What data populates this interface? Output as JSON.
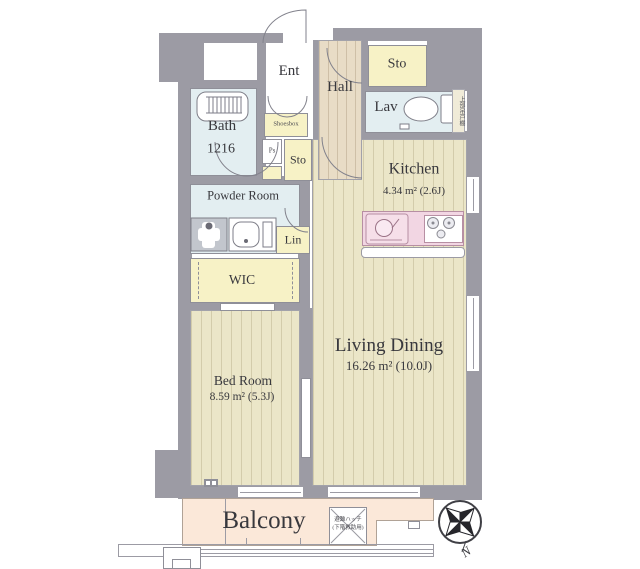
{
  "plan_title": "apartment-floor-plan",
  "rooms": {
    "ent": "Ent",
    "hall": "Hall",
    "sto_upper": "Sto",
    "sto_entry": "Sto",
    "lav": "Lav",
    "bath_name": "Bath",
    "bath_size": "1216",
    "shoesbox": "Shoesbox",
    "ps": "Ps",
    "powder_room": "Powder Room",
    "lin": "Lin",
    "wic": "WIC",
    "kitchen_name": "Kitchen",
    "kitchen_area": "4.34 m² (2.6J)",
    "living_name": "Living Dining",
    "living_area": "16.26 m² (10.0J)",
    "bed_name": "Bed Room",
    "bed_area": "8.59 m² (5.3J)",
    "balcony": "Balcony"
  },
  "annotations": {
    "upper_cabinet": "上部吊戸棚",
    "hatch_line1": "避難ハッチ",
    "hatch_line2": "(下階救助用)",
    "north": "N"
  },
  "colors": {
    "wall": "#9c9ba4",
    "floor": "#ebe6c8",
    "hall_floor": "#e8dcc6",
    "wet_room": "#e3eef1",
    "storage": "#f7f2c6",
    "balcony": "#fbe8d9",
    "kitchen_counter": "#f2d6e3"
  }
}
